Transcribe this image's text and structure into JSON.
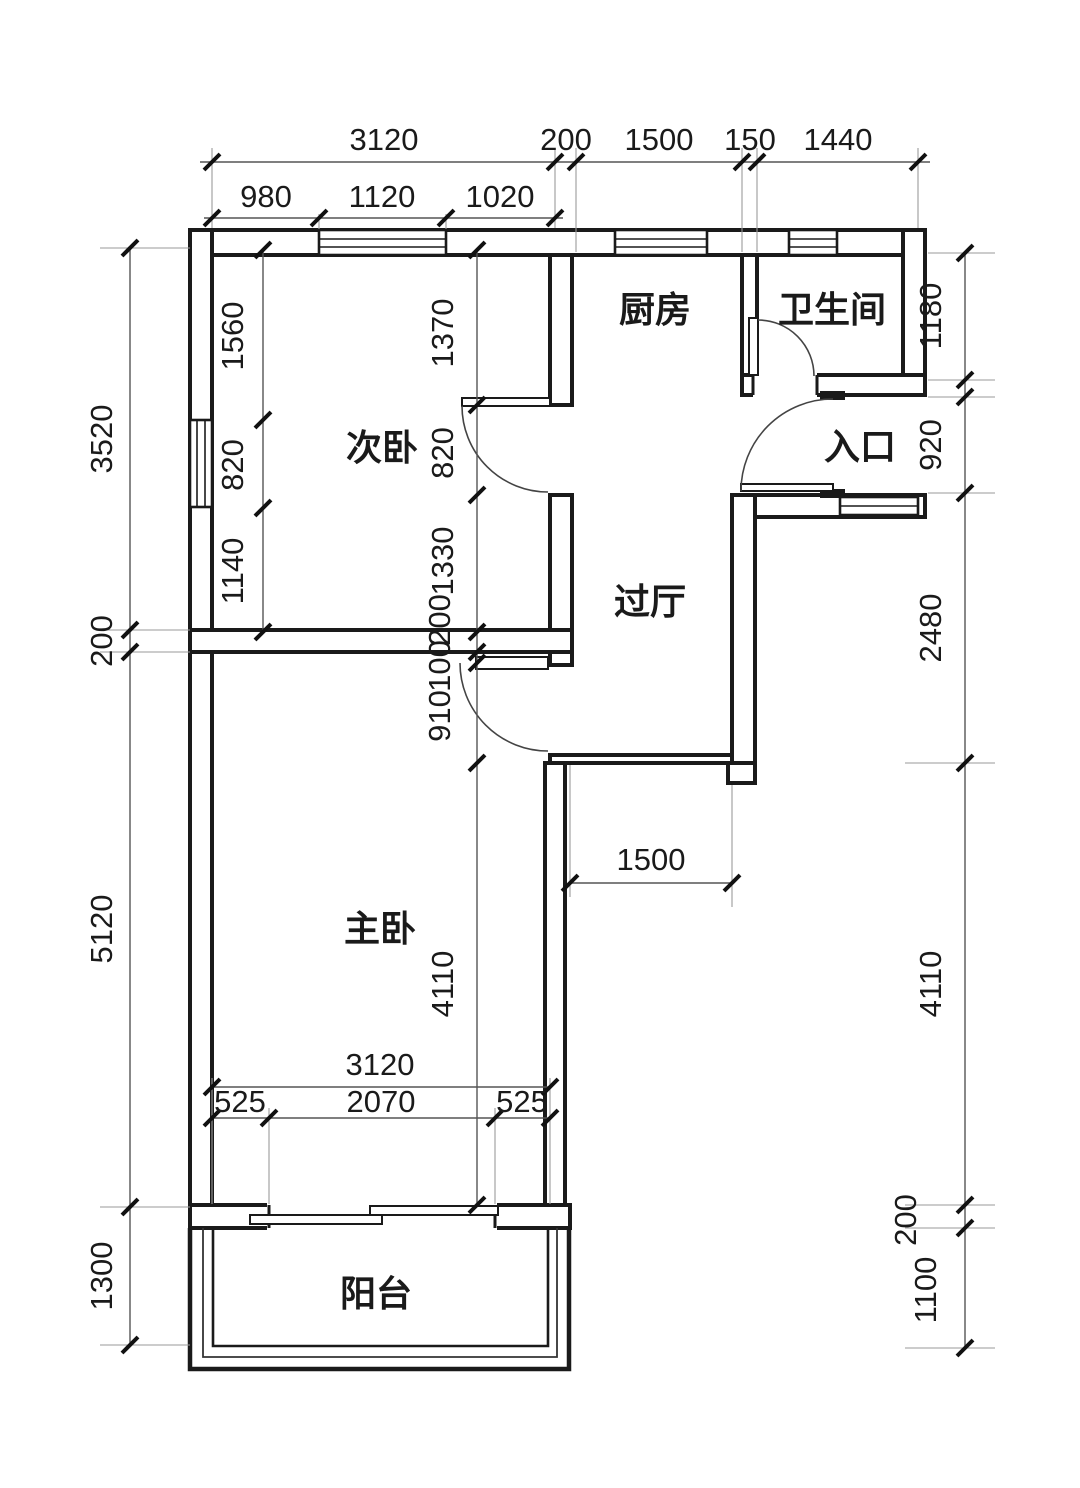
{
  "rooms": {
    "kitchen": "厨房",
    "bathroom": "卫生间",
    "secondary_bedroom": "次卧",
    "entrance": "入口",
    "hallway": "过厅",
    "master_bedroom": "主卧",
    "balcony": "阳台"
  },
  "dims": {
    "top_outer": [
      "3120",
      "200",
      "1500",
      "150",
      "1440"
    ],
    "top_inner": [
      "980",
      "1120",
      "1020"
    ],
    "left_col": [
      "3520",
      "200",
      "5120",
      "1300"
    ],
    "right_col": [
      "1180",
      "920",
      "2480",
      "4110",
      "200",
      "1100"
    ],
    "bed2_left": [
      "1560",
      "820",
      "1140"
    ],
    "bed2_right": [
      "1370",
      "820",
      "1330"
    ],
    "door_col": [
      "200",
      "100",
      "910"
    ],
    "master_height": "4110",
    "hall_width": "1500",
    "master_top": "3120",
    "balcony_door": [
      "525",
      "2070",
      "525"
    ]
  },
  "colors": {
    "wall_line": "#1a1a1a",
    "extension_line": "#9a9a9a",
    "dimension_text": "#1a1a1a",
    "background": "#ffffff"
  }
}
